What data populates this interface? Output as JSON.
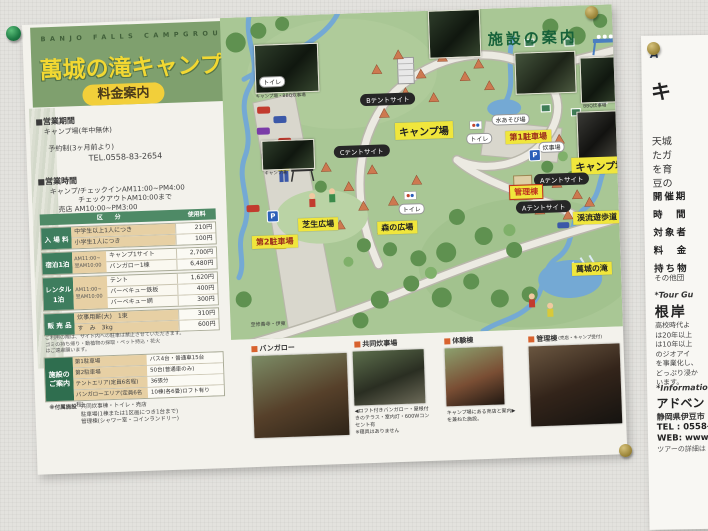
{
  "colors": {
    "band_green": "#7fa06e",
    "title_yellow": "#f2d832",
    "map_green": "#a9c795",
    "label_yellow": "#f0e63c",
    "table_green": "#3e7d5e",
    "tan": "#e7d0a4",
    "river_blue": "#74a9d4"
  },
  "poster": {
    "header": {
      "en": "BANJO FALLS CAMPGROUND",
      "title": "萬城の滝キャンプ場",
      "fee_badge": "料金案内"
    },
    "info": {
      "season_head": "■営業期間",
      "season1": "キャンプ場(年中無休)",
      "season2": "予約制(3ヶ月前より)",
      "tel": "TEL.0558-83-2654",
      "hours_head": "■営業時間",
      "hours1": "キャンプ/チェックインAM11:00~PM4:00",
      "hours2": "チェックアウトAM10:00まで",
      "hours3": "売店 AM10:00~PM3:00"
    },
    "fee_table": {
      "col_category": "区　　分",
      "col_fee": "使用料",
      "groups": [
        {
          "name": "入 場 料",
          "time": "",
          "tan": true,
          "items": [
            [
              "中学生以上1人につき",
              "210円"
            ],
            [
              "小学生1人につき",
              "100円"
            ]
          ]
        },
        {
          "name": "宿泊1泊",
          "time": "AM11:00~翌AM10:00",
          "tan": false,
          "items": [
            [
              "キャンプ1サイト",
              "2,700円"
            ],
            [
              "バンガロー1棟",
              "6,480円"
            ]
          ]
        },
        {
          "name": "レンタル 1泊",
          "time": "AM11:00~翌AM10:00",
          "tan": false,
          "items": [
            [
              "テント",
              "1,620円"
            ],
            [
              "バーベキュー鉄板",
              "400円"
            ],
            [
              "バーベキュー網",
              "300円"
            ]
          ]
        },
        {
          "name": "販 売 品",
          "time": "",
          "tan": true,
          "items": [
            [
              "炊事用薪(大)　1束",
              "310円"
            ],
            [
              "す　み　3kg",
              "600円"
            ]
          ]
        }
      ]
    },
    "notes": [
      "ご利用の際は、サイト内への駐車は禁止させていただきます。",
      "ゴミの持ち帰り・動植物の採取・ペット持込・花火",
      "はご遠慮願います。"
    ],
    "facility_table": {
      "title": "施設の ご案内",
      "rows": [
        [
          "第1駐車場",
          "バス4台・普通車15台"
        ],
        [
          "第2駐車場",
          "50台(普通車のみ)"
        ],
        [
          "テントエリア(定員6名程)",
          "36張分"
        ],
        [
          "バンガローエリア(定員6名程)",
          "10棟(各6畳)ロフト有り"
        ]
      ]
    },
    "attached": {
      "label": "※付属施設",
      "lines": [
        "共同炊事棟・トイレ・売店",
        "駐車場(1棟または1区画につき1台まで)",
        "管理棟(シャワー室・コインランドリー)"
      ]
    },
    "map": {
      "guide_title": "施設の案内",
      "labels": {
        "camp_upper": "キャンプ場",
        "camp_right": "キャンプ場",
        "tent_a": "Aテントサイト",
        "tent_b": "Bテントサイト",
        "tent_c": "Cテントサイト",
        "toilet": "トイレ",
        "cook": "炊事場",
        "water_play": "水あそび場",
        "parking1": "第1駐車場",
        "parking2": "第2駐車場",
        "lawn": "芝生広場",
        "forest": "森の広場",
        "admin": "管理棟",
        "stream_path": "渓流遊歩道",
        "falls": "萬城の滝",
        "road_note": "至修善寺・伊東",
        "parking_p": "P"
      },
      "photo_captions": {
        "p1": "キャンプ場・BBQ炊事場",
        "p2": "キャンプ場",
        "p5": "BBQ炊事場",
        "p6": "キャンプ場"
      }
    },
    "bottom": {
      "sections": [
        {
          "heading": "バンガロー",
          "sub": "",
          "caption": ""
        },
        {
          "heading": "共同炊事場",
          "sub": "",
          "caption": "◀ロフト付きバンガロー・屋根付\nきのテラス・室内灯・600Wコン\nセント有\n※寝具はありません"
        },
        {
          "heading": "体験棟",
          "sub": "",
          "caption": "キャンプ場にある売店と案内▶\nを兼ねた施設。"
        },
        {
          "heading": "管理棟",
          "sub": "(売店・キャンプ受付)",
          "caption": ""
        }
      ]
    }
  },
  "side_poster": {
    "top": "A",
    "big": "キ",
    "para": [
      "天城",
      "たガ",
      "を育",
      "豆の"
    ],
    "fields": [
      "開催期",
      "時　間",
      "対象者",
      "料　金",
      "持ち物"
    ],
    "other": "その他団",
    "tour_label": "*Tour Gu",
    "name": "根岸",
    "bio": [
      "高校時代よ",
      "は20年以上",
      "は10年以上",
      "のジオアイ",
      "を事業化し、",
      "どっぷり浸か",
      "います。"
    ],
    "info_label": "*Information",
    "org": "アドベン",
    "addr": "静岡県伊豆市",
    "tel": "TEL : 0558-99",
    "web": "WEB: www.a",
    "note": "ツアーの詳細は"
  }
}
